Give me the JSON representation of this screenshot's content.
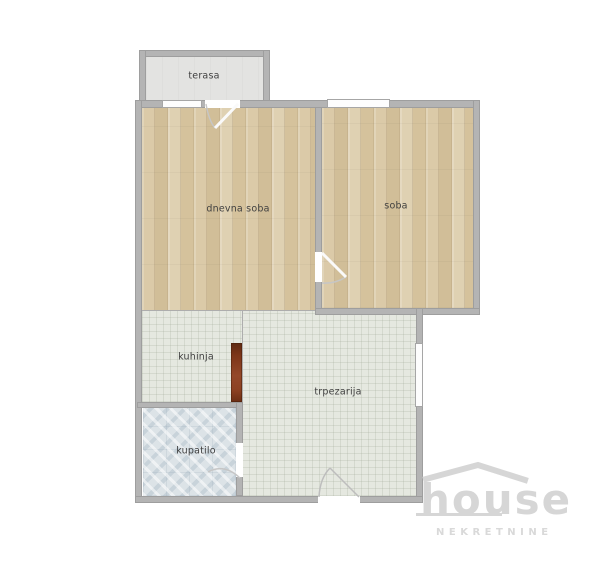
{
  "page": {
    "width": 600,
    "height": 562,
    "background": "#ffffff"
  },
  "floorplan": {
    "rooms": [
      {
        "name": "terasa",
        "floor_type": "terrace"
      },
      {
        "name": "dnevna soba",
        "floor_type": "wood"
      },
      {
        "name": "soba",
        "floor_type": "wood"
      },
      {
        "name": "kuhinja",
        "floor_type": "tile"
      },
      {
        "name": "trpezarija",
        "floor_type": "tile"
      },
      {
        "name": "kupatilo",
        "floor_type": "bathroom-tile"
      }
    ],
    "colors": {
      "wall": "#b4b4b4",
      "wood_floor": "#d7c5a2",
      "kitchen_tile": "#e5e8e0",
      "bathroom_tile": "#dce3e7",
      "terrace_floor": "#e3e3e1",
      "counter": "#8c4122",
      "label_text": "#3f3f3f"
    }
  },
  "watermark": {
    "brand": "house",
    "subtitle": "NEKRETNINE",
    "color": "#d6d6d6"
  }
}
